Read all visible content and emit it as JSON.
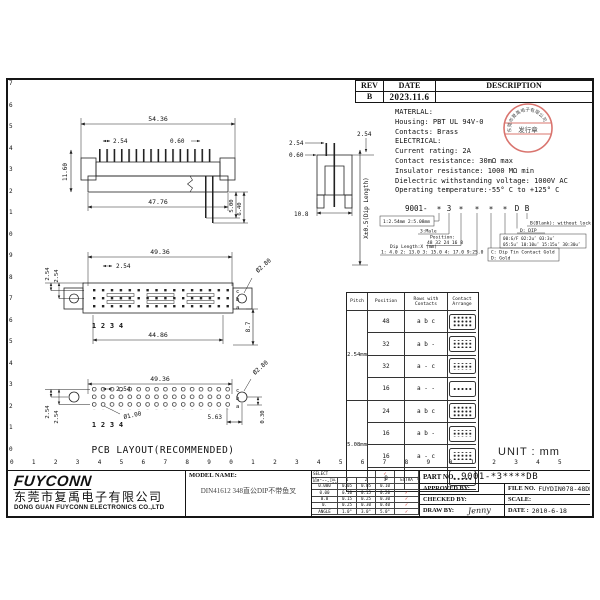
{
  "colors": {
    "accent_red": "#c9342c",
    "line": "#1a1a1a"
  },
  "frame": {
    "left_ruler": [
      "7",
      "6",
      "5",
      "4",
      "3",
      "2",
      "1",
      "0",
      "9",
      "8",
      "7",
      "6",
      "5",
      "4",
      "3",
      "2",
      "1",
      "0"
    ],
    "bottom_ruler": [
      "0",
      "1",
      "2",
      "3",
      "4",
      "5",
      "6",
      "7",
      "8",
      "9",
      "0",
      "1",
      "2",
      "3",
      "4",
      "5",
      "6",
      "7",
      "8",
      "9",
      "0",
      "1",
      "2",
      "3",
      "4",
      "5"
    ]
  },
  "rev_table": {
    "col_rev": "REV",
    "col_date": "DATE",
    "col_desc": "DESCRIPTION",
    "rev": "B",
    "date": "2023.11.6",
    "desc": ""
  },
  "material": {
    "lines": [
      "MATERLAL:",
      "Housing: PBT UL 94V-0",
      "Contacts: Brass",
      "ELECTRICAL:",
      "Current rating: 2A",
      "Contact resistance: 30mΩ max",
      "Insulator resistance: 1000 MΩ min",
      "Dielectric withstanding voltage: 1000V AC",
      "Operating temperature:-55° C to +125° C"
    ]
  },
  "stamp": {
    "arc_text": "东莞市复禹电子有限公司",
    "band_text": "发行章"
  },
  "part_code": {
    "base": "9001-",
    "symbols": [
      "*",
      "3",
      "*",
      "*",
      "*",
      "*",
      "D",
      "B"
    ],
    "pitch_box": "1:2.54mm 2:5.08mm",
    "male": "3:Male",
    "position_label": "Position:",
    "position_values": "48 32 24 16 8",
    "dip_label": "Dip Length:X (mm)",
    "dip_values": "1: 4.0 2: 13.0 3: 15.0 4: 17.0 9:25.0",
    "lock": "B(Blank): without lock",
    "dip_pkg": "D: DIP",
    "plating1": "00:G/F  02:2u″  03:3u″",
    "plating2": "05:5u″ 10:10u″ 15:15u″ 30:30u″",
    "contact1": "C: Dip Tin Contact Gold",
    "contact2": "D: Gold"
  },
  "pitch_table": {
    "headers": [
      "Pitch",
      "Position",
      "Rows with Contacts",
      "Contact Arrange"
    ],
    "groups": [
      {
        "pitch": "2.54mm",
        "rows": [
          {
            "position": "48",
            "contacts": "a b c"
          },
          {
            "position": "32",
            "contacts": "a b -"
          },
          {
            "position": "32",
            "contacts": "a - c"
          },
          {
            "position": "16",
            "contacts": "a - -"
          }
        ]
      },
      {
        "pitch": "5.08mm",
        "rows": [
          {
            "position": "24",
            "contacts": "a b c"
          },
          {
            "position": "16",
            "contacts": "a b -"
          },
          {
            "position": "16",
            "contacts": "a - c"
          },
          {
            "position": "8",
            "contacts": "a - -"
          }
        ]
      }
    ]
  },
  "views": {
    "front": {
      "dim_top": "54.36",
      "dim_pitch": "2.54",
      "dim_pin": "0.60",
      "dim_height": "11.60",
      "dim_bottom": "47.76",
      "dim_tail_a": "5.00",
      "dim_tail_b": "6.40"
    },
    "side": {
      "dim_left": "2.54",
      "dim_right": "2.54",
      "dim_pin": "0.60",
      "dim_width": "10.8",
      "axis_label": "X±0.5(Dip Length)"
    },
    "top": {
      "dim_width": "49.36",
      "dim_pitch": "2.54",
      "dim_row_a": "2.54",
      "dim_row_b": "2.54",
      "dim_hole": "Ø2.80",
      "dim_bottom": "44.86",
      "dim_height": "8.7",
      "rows": [
        "c",
        "b",
        "a"
      ],
      "pins": [
        "1",
        "2",
        "3",
        "4"
      ]
    },
    "pcb": {
      "dim_width": "49.36",
      "dim_pitch": "2.54",
      "dim_hole_small": "Ø1.00",
      "dim_hole_big": "Ø2.80",
      "dim_inset": "5.63",
      "dim_edge": "0.30",
      "dim_row_a": "2.54",
      "dim_row_b": "2.54",
      "rows": [
        "c",
        "b",
        "a"
      ],
      "pins": [
        "1",
        "2",
        "3",
        "4"
      ],
      "caption": "PCB LAYOUT(RECOMMENDED)"
    }
  },
  "unit_label": "UNIT : mm",
  "title_block": {
    "logo": "FUYCONN",
    "company_cn": "东莞市复禹电子有限公司",
    "company_en": "DONG GUAN FUYCONN ELECTRONICS CO.,LTD",
    "model_label": "MODEL NAME:",
    "model_value": "DIN41612  348直公DIP不带鱼叉",
    "tolerance": {
      "select_label": "SELECT",
      "select_check": "✓",
      "dim_label": "DIM",
      "tol_label": "TOL",
      "cols": [
        "1",
        "2",
        "3",
        "EXTRA"
      ],
      "rows": [
        {
          "dim": "0.000",
          "t1": "0.05",
          "t2": "0.05",
          "t3": "0.10",
          "extra": ""
        },
        {
          "dim": "0.00",
          "t1": "0.10",
          "t2": "0.15",
          "t3": "0.20",
          "extra": "✓"
        },
        {
          "dim": "0.0",
          "t1": "0.15",
          "t2": "0.25",
          "t3": "0.30",
          "extra": "✓"
        },
        {
          "dim": "0.",
          "t1": "0.25",
          "t2": "0.30",
          "t3": "0.40",
          "extra": "✓"
        },
        {
          "dim": "ANGLE",
          "t1": "1.0°",
          "t2": "3.0°",
          "t3": "5.0°",
          "extra": "✓"
        }
      ]
    },
    "part_no_label": "PART NO.",
    "part_no": "9001-*3****DB",
    "approved_label": "APPROVED BY:",
    "checked_label": "CHECKED BY:",
    "draw_label": "DRAW BY:",
    "draw_by": "Jenny",
    "file_label": "FILE NO.",
    "file_no": "FUYDIN078-48DB",
    "scale_label": "SCALE:",
    "date_label": "DATE :",
    "date": "2010-6-18"
  }
}
